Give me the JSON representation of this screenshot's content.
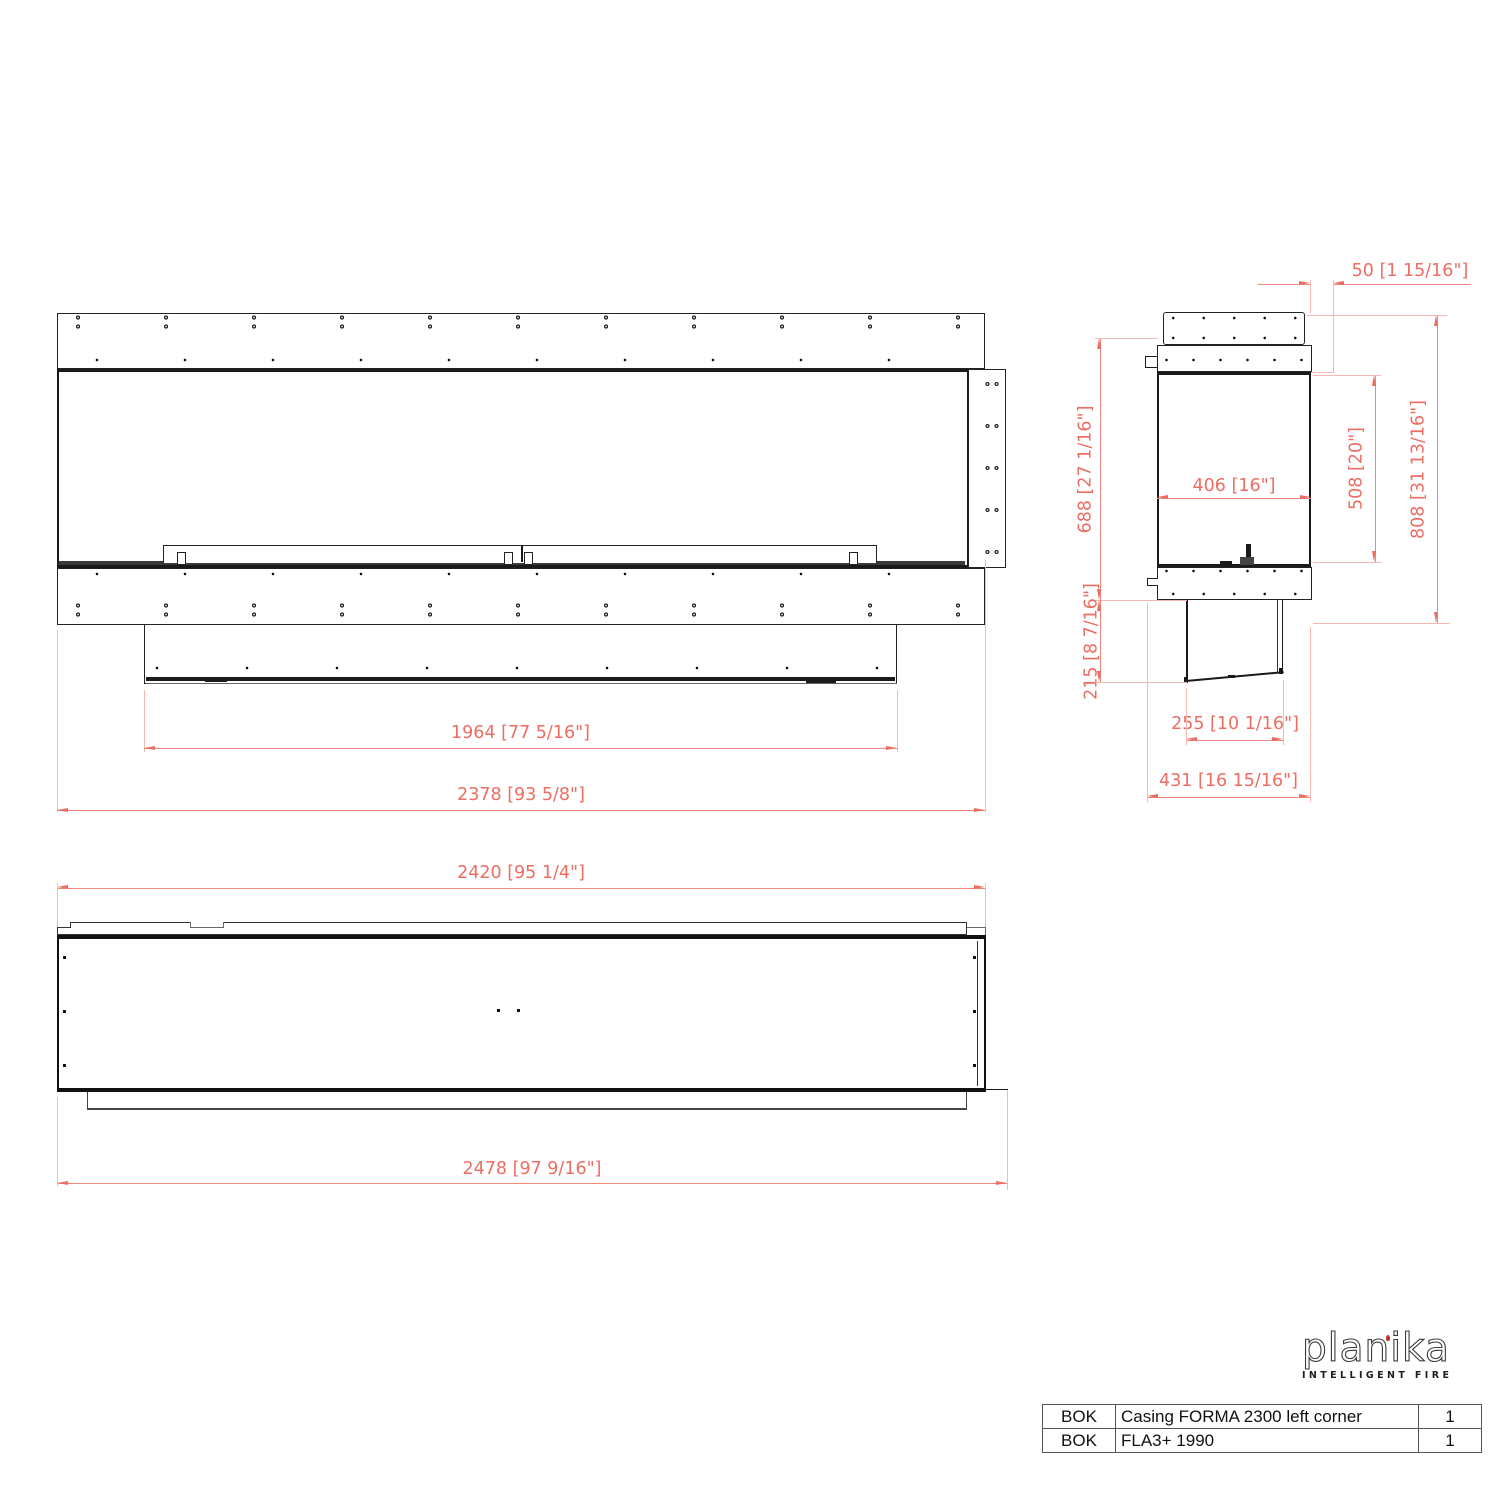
{
  "front_view": {
    "dim_inner_width": "1964 [77 5/16\"]",
    "dim_overall_width": "2378 [93 5/8\"]"
  },
  "side_view": {
    "dim_top_offset": "50 [1 15/16\"]",
    "dim_body_height": "688 [27 1/16\"]",
    "dim_opening_depth": "406 [16\"]",
    "dim_opening_height": "508 [20\"]",
    "dim_overall_height": "808 [31 13/16\"]",
    "dim_lower_height": "215 [8 7/16\"]",
    "dim_lower_depth": "255 [10 1/16\"]",
    "dim_overall_depth": "431 [16 15/16\"]"
  },
  "top_view": {
    "dim_body_width": "2420 [95 1/4\"]",
    "dim_overall_width": "2478 [97 9/16\"]"
  },
  "logo": {
    "brand": "planika",
    "tagline": "INTELLIGENT FIRE"
  },
  "bom": {
    "rows": [
      {
        "code": "BOK",
        "description": "Casing FORMA 2300 left corner",
        "qty": "1"
      },
      {
        "code": "BOK",
        "description": "FLA3+ 1990",
        "qty": "1"
      }
    ]
  },
  "colors": {
    "dimension_red": "#ec6e63",
    "extension_red": "#f6b8b1",
    "line_black": "#1a1a1a"
  }
}
